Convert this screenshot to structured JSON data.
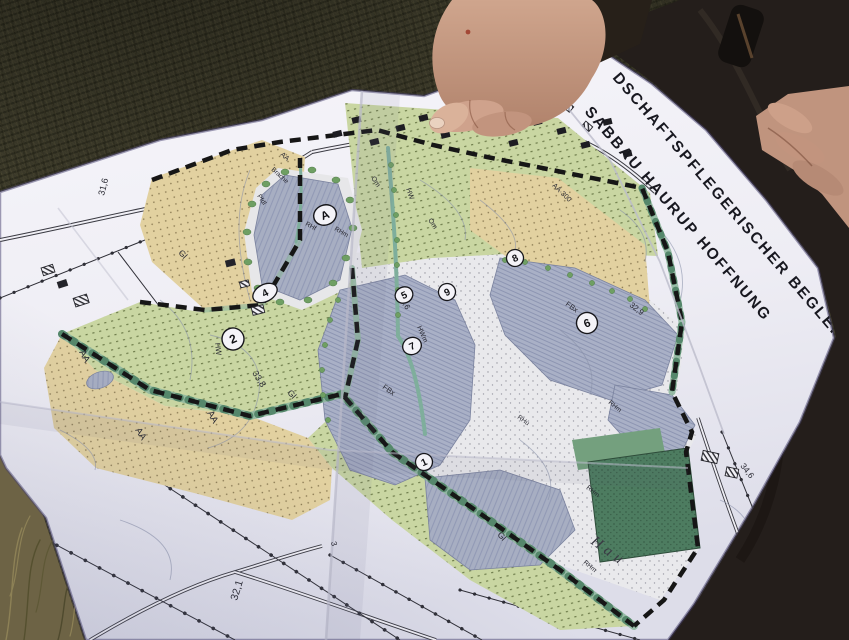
{
  "map": {
    "title": {
      "line1": "DSCHAFTSPFLEGERISCHER BEGLEIT",
      "line2": "SABBAU HAURUP HOFFNUNG"
    },
    "markers": [
      {
        "id": "A"
      },
      {
        "id": "1"
      },
      {
        "id": "2"
      },
      {
        "id": "4"
      },
      {
        "id": "5"
      },
      {
        "id": "6"
      },
      {
        "id": "7"
      },
      {
        "id": "8"
      },
      {
        "id": "9"
      }
    ],
    "labels": [
      {
        "text": "31,6"
      },
      {
        "text": "32,1"
      },
      {
        "text": "32,6"
      },
      {
        "text": "32,9"
      },
      {
        "text": "33,8"
      },
      {
        "text": "34,6"
      },
      {
        "text": "AA"
      },
      {
        "text": "AA"
      },
      {
        "text": "AA"
      },
      {
        "text": "AA·300"
      },
      {
        "text": "AA"
      },
      {
        "text": "Brache"
      },
      {
        "text": "Gl"
      },
      {
        "text": "Gl"
      },
      {
        "text": "Gl"
      },
      {
        "text": "Om"
      },
      {
        "text": "Om"
      },
      {
        "text": "HW"
      },
      {
        "text": "HW"
      },
      {
        "text": "HWm"
      },
      {
        "text": "FBx"
      },
      {
        "text": "FBx"
      },
      {
        "text": "RHm"
      },
      {
        "text": "RHm"
      },
      {
        "text": "RHm"
      },
      {
        "text": "RHm"
      },
      {
        "text": "RHf"
      },
      {
        "text": "RHu"
      },
      {
        "text": "Pfdl"
      },
      {
        "text": "Hau"
      },
      {
        "text": "3"
      }
    ]
  },
  "colors": {
    "paper": "#f0eff5",
    "field_green": "#c9d6a2",
    "field_tan": "#e2d1a0",
    "water": "#a9b0c6",
    "forest_dark": "#4d7c60",
    "hedge": "#8fb79f",
    "boundary": "#1a1a1a",
    "grass": "#3f3d2c",
    "dry_grass": "#6d6345",
    "jacket": "#241e1b",
    "skin": "#c79d88"
  }
}
